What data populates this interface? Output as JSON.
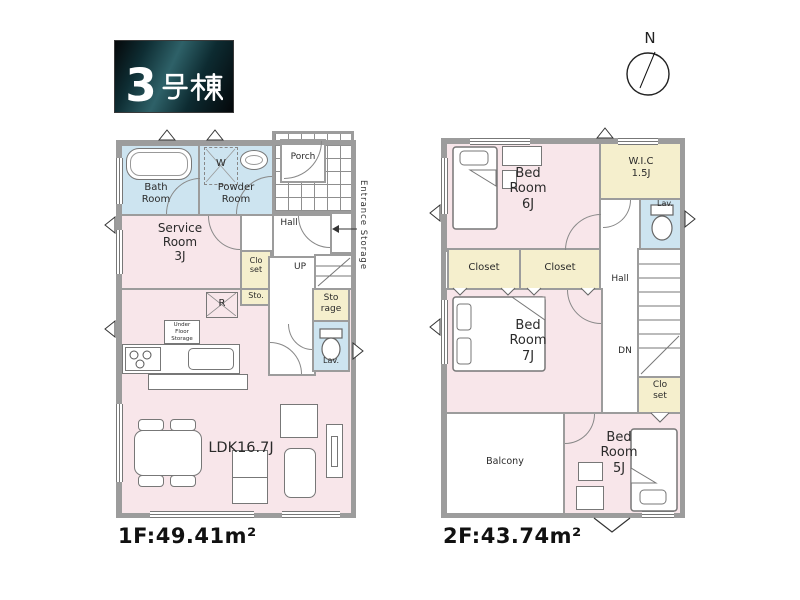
{
  "title_badge": {
    "text": "3号棟",
    "number": "3",
    "suffix": "号棟"
  },
  "compass": {
    "north": "N"
  },
  "colors": {
    "room-pink": "#f8e6ea",
    "room-blue": "#cde4f0",
    "room-yellow": "#f5efcd",
    "wall": "#9c9c9c",
    "badge-teal": "#2e6168"
  },
  "floor1": {
    "area": "1F:49.41m²",
    "labels": {
      "bath": "Bath\nRoom",
      "powder": "Powder\nRoom",
      "washer": "W",
      "porch": "Porch",
      "hall": "Hall",
      "entrance_storage": "Entrance Storage",
      "service": "Service\nRoom\n3J",
      "closet": "Clo\nset",
      "sto": "Sto.",
      "storage": "Sto\nrage",
      "up": "UP",
      "fridge": "R",
      "under_floor": "Under\nFloor\nStorage",
      "lav": "Lav.",
      "ldk": "LDK16.7J"
    }
  },
  "floor2": {
    "area": "2F:43.74m²",
    "labels": {
      "bed6": "Bed\nRoom\n6J",
      "wic": "W.I.C\n1.5J",
      "lav": "Lav.",
      "closet_a": "Closet",
      "closet_b": "Closet",
      "hall": "Hall",
      "bed7": "Bed\nRoom\n7J",
      "dn": "DN",
      "closet_c": "Clo\nset",
      "balcony": "Balcony",
      "bed5": "Bed\nRoom\n5J"
    }
  }
}
